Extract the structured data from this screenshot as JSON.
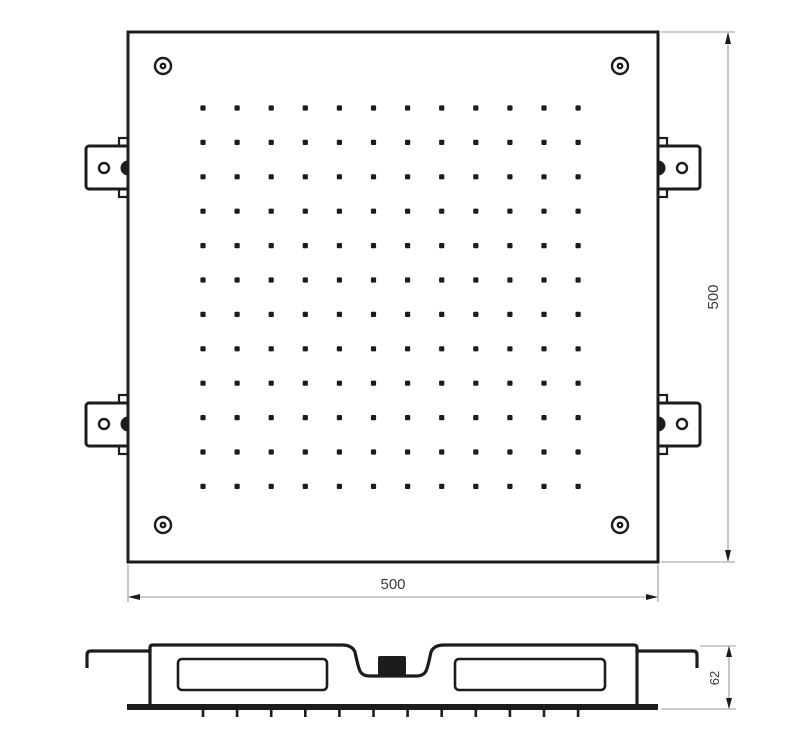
{
  "drawing": {
    "title": "square-ceiling-showerhead-technical-drawing",
    "views": {
      "top_view": "plan view with nozzle grid, corner screws and mounting brackets",
      "side_view": "profile section with central inlet and nozzle face"
    },
    "dimensions": {
      "width_label": "500",
      "height_label": "500",
      "depth_label": "62"
    },
    "nozzle_grid": {
      "rows": 12,
      "cols": 12
    },
    "nozzle_ticks": 12,
    "corner_screws": 4,
    "mounting_brackets": 4,
    "colors": {
      "line": "#1c1c1c",
      "dim_line": "#9b9b9b",
      "dim_text": "#3a3a3a",
      "background": "#ffffff"
    }
  }
}
